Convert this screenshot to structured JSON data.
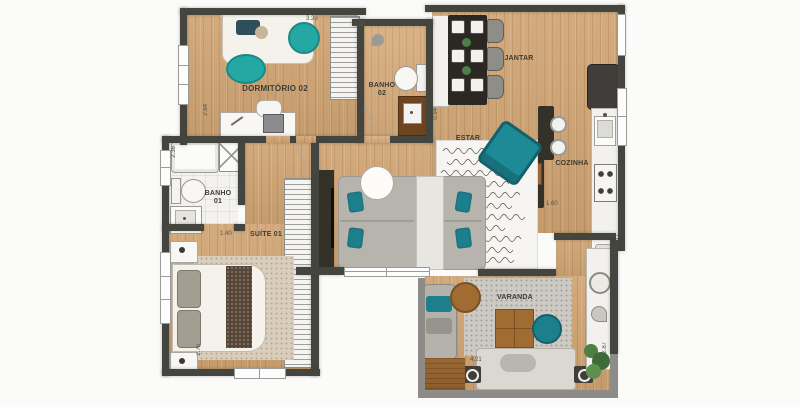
{
  "rooms": {
    "dormitorio02": {
      "label": "DORMITÓRIO 02"
    },
    "banho02": {
      "label_line1": "BANHO",
      "label_line2": "02"
    },
    "jantar": {
      "label": "JANTAR"
    },
    "cozinha": {
      "label": "COZINHA"
    },
    "estar": {
      "label": "ESTAR"
    },
    "banho01": {
      "label_line1": "BANHO",
      "label_line2": "01"
    },
    "suite01": {
      "label": "SUÍTE 01"
    },
    "varanda": {
      "label": "VARANDA"
    }
  },
  "dims": {
    "dorm02_width": "3.20",
    "dorm02_depth": "2.64",
    "banho02_width": "1.38",
    "estar_opening": "0.94",
    "banho01_depth": "2.36",
    "suite01_entry": "1.40",
    "cozinha_width": "1.60",
    "suite01_depth": "2.76",
    "varanda_width": "4.21",
    "varanda_depth": "2.87"
  },
  "colors": {
    "wall": "#454540",
    "outer_wall": "#8d8c88",
    "wood_floor": "#cda377",
    "accent_teal": "#1d8a96",
    "accent_teal_bright": "#25a7a3",
    "sofa_gray": "#b7b4ae",
    "rug_beige": "#d9cebc",
    "rug_gray": "#cdcac4",
    "dark_furniture": "#2b2722",
    "wood_furniture": "#a06c32",
    "vanity_brown": "#6e4520"
  }
}
